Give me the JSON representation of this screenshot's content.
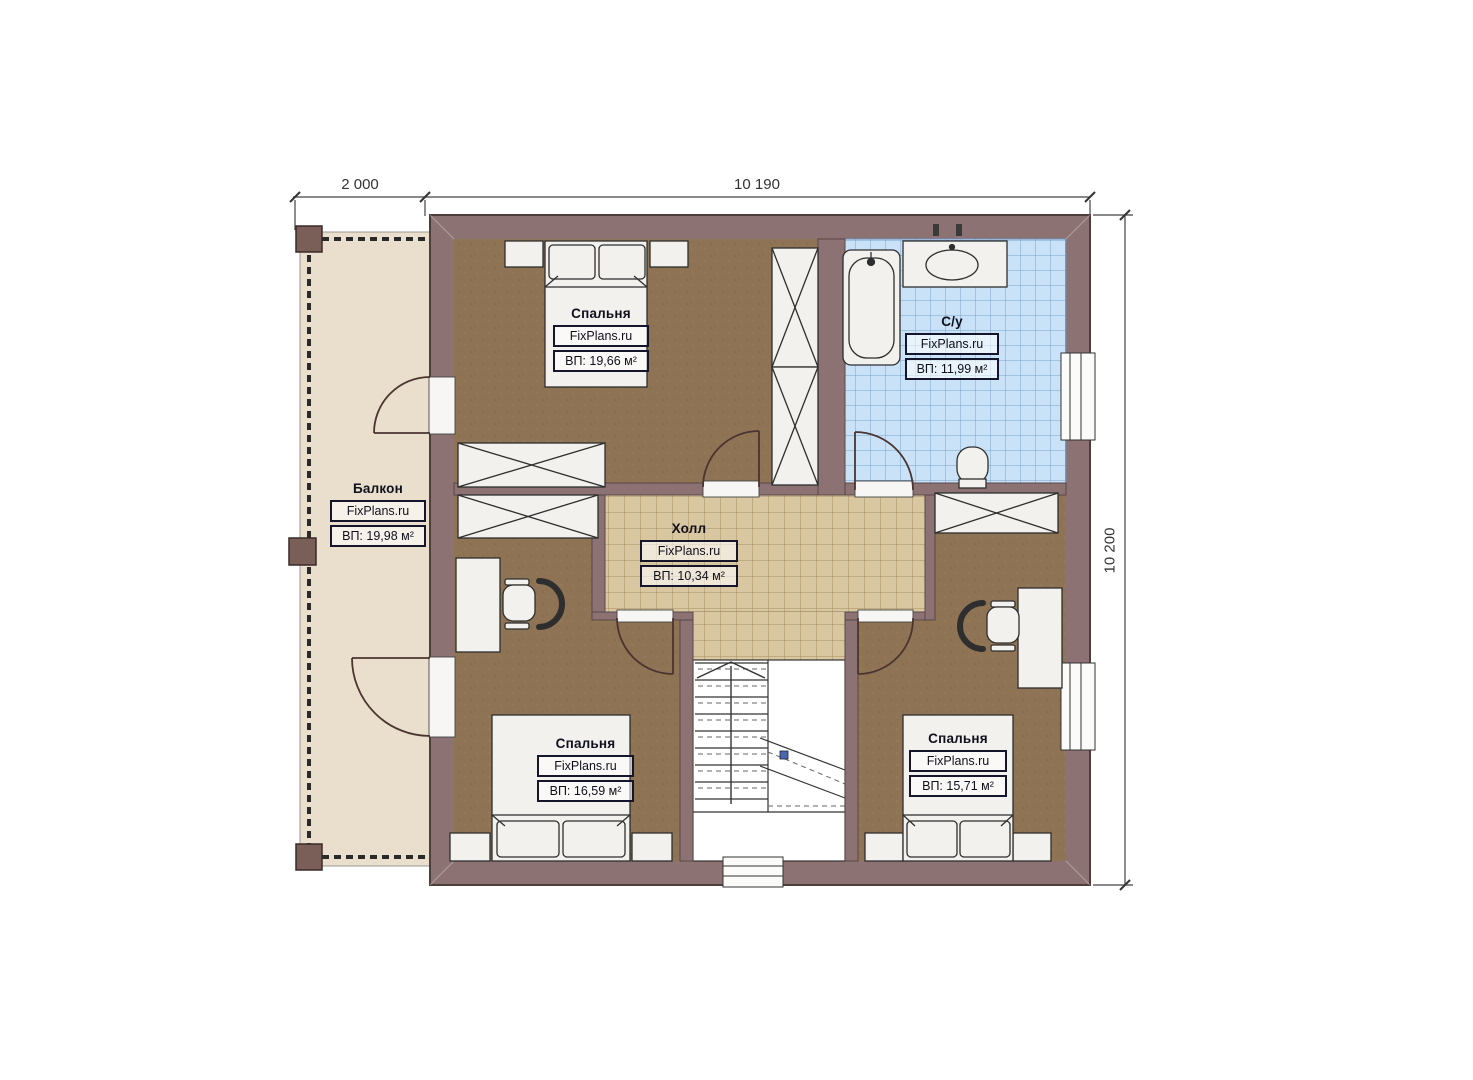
{
  "plan": {
    "type": "floor-plan-second-storey",
    "watermark": "FixPlans.ru"
  },
  "dimensions": {
    "top_span_left": "2 000",
    "top_span_right": "10 190",
    "right_span": "10 200"
  },
  "rooms": {
    "balcony": {
      "name": "Балкон",
      "brand": "FixPlans.ru",
      "area": "ВП: 19,98 м²"
    },
    "bedroom_top_left": {
      "name": "Спальня",
      "brand": "FixPlans.ru",
      "area": "ВП: 19,66 м²"
    },
    "bathroom": {
      "name": "С/у",
      "brand": "FixPlans.ru",
      "area": "ВП: 11,99 м²"
    },
    "hall": {
      "name": "Холл",
      "brand": "FixPlans.ru",
      "area": "ВП: 10,34 м²"
    },
    "bedroom_bottom_left": {
      "name": "Спальня",
      "brand": "FixPlans.ru",
      "area": "ВП: 16,59 м²"
    },
    "bedroom_bottom_right": {
      "name": "Спальня",
      "brand": "FixPlans.ru",
      "area": "ВП: 15,71 м²"
    }
  },
  "colors": {
    "wall": "#8c7273",
    "wall_outline": "#4e3d3d",
    "bedroom_floor": "#8e7354",
    "hall_floor": "#d8c7a0",
    "balcony_floor": "#e9dfcc",
    "bathroom_tile": "#c9e2f8",
    "bathroom_grid": "#7ba1cc",
    "furniture": "#f2f1ee",
    "stair_marker_blue": "#4a66b0"
  }
}
